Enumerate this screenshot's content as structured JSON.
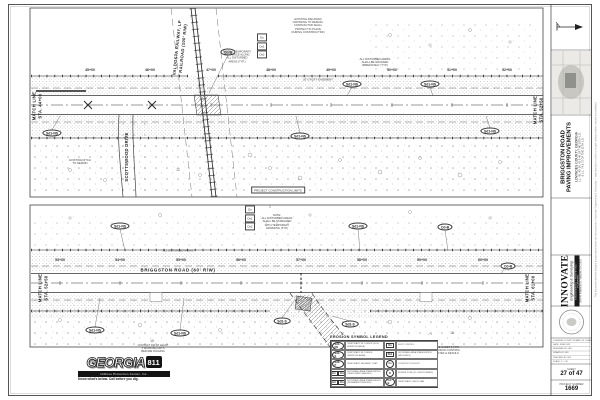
{
  "colors": {
    "paper": "#ffffff",
    "ink": "#2b2b2b",
    "muted": "#8f8f8f"
  },
  "plans": {
    "top": {
      "match_left": "MATCH LINE / STA. 44+00",
      "match_right": "MATCH LINE / STA. 52+50",
      "railroad_label": "VALDOSTA RAILWAY, LP RAILROAD (100' R/W)",
      "side_road_label": "SCOTTSWOOD DRIVE"
    },
    "bottom": {
      "match_left": "MATCH LINE / STA. 52+50",
      "match_right": "MATCH LINE / STA. 61+00",
      "road_label": "BRIGGSTON ROAD (60' R/W)"
    }
  },
  "annotations": [
    {
      "type": "vtext",
      "name": "match-line-top-left",
      "x": 37,
      "y": 106,
      "lines": [
        "MATCH LINE",
        "STA. 44+00"
      ]
    },
    {
      "type": "vtext",
      "name": "match-line-top-right",
      "x": 538,
      "y": 110,
      "lines": [
        "MATCH LINE",
        "STA. 52+50"
      ]
    },
    {
      "type": "vtext",
      "name": "match-line-bottom-left",
      "x": 43,
      "y": 288,
      "lines": [
        "MATCH LINE",
        "STA. 52+50"
      ]
    },
    {
      "type": "vtext",
      "name": "match-line-bottom-right",
      "x": 530,
      "y": 288,
      "lines": [
        "MATCH LINE",
        "STA. 61+00"
      ]
    },
    {
      "type": "vtext",
      "name": "railroad-label",
      "x": 180,
      "y": 48,
      "rot": -84,
      "lines": [
        "VALDOSTA RAILWAY, LP",
        "RAILROAD (100' R/W)"
      ]
    },
    {
      "type": "vtext",
      "name": "side-road-label",
      "x": 127,
      "y": 157,
      "lines": [
        "SCOTTSWOOD DRIVE"
      ]
    },
    {
      "type": "hlabel",
      "name": "road-label",
      "x": 178,
      "y": 270,
      "text": "BRIGGSTON ROAD (60' R/W)"
    },
    {
      "type": "station",
      "x": 90,
      "y": 70,
      "text": "45+00"
    },
    {
      "type": "station",
      "x": 150,
      "y": 70,
      "text": "46+00"
    },
    {
      "type": "station",
      "x": 211,
      "y": 70,
      "text": "47+00"
    },
    {
      "type": "station",
      "x": 271,
      "y": 70,
      "text": "48+00"
    },
    {
      "type": "station",
      "x": 331,
      "y": 70,
      "text": "49+00"
    },
    {
      "type": "station",
      "x": 392,
      "y": 70,
      "text": "50+00"
    },
    {
      "type": "station",
      "x": 452,
      "y": 70,
      "text": "51+00"
    },
    {
      "type": "station",
      "x": 507,
      "y": 70,
      "text": "52+00"
    },
    {
      "type": "station",
      "x": 60,
      "y": 260,
      "text": "53+00"
    },
    {
      "type": "station",
      "x": 120,
      "y": 260,
      "text": "54+00"
    },
    {
      "type": "station",
      "x": 181,
      "y": 260,
      "text": "55+00"
    },
    {
      "type": "station",
      "x": 241,
      "y": 260,
      "text": "56+00"
    },
    {
      "type": "station",
      "x": 301,
      "y": 260,
      "text": "57+00"
    },
    {
      "type": "station",
      "x": 362,
      "y": 260,
      "text": "58+00"
    },
    {
      "type": "station",
      "x": 422,
      "y": 260,
      "text": "59+00"
    },
    {
      "type": "station",
      "x": 483,
      "y": 260,
      "text": "60+00"
    },
    {
      "type": "oval",
      "x": 52,
      "y": 133,
      "text": "Sd1-NS"
    },
    {
      "type": "oval",
      "x": 228,
      "y": 52,
      "text": "Cd-B"
    },
    {
      "type": "oval",
      "x": 352,
      "y": 84,
      "text": "Sd1-NS"
    },
    {
      "type": "oval",
      "x": 430,
      "y": 84,
      "text": "Sd1-NS"
    },
    {
      "type": "oval",
      "x": 300,
      "y": 136,
      "text": "Sd1-NS"
    },
    {
      "type": "oval",
      "x": 490,
      "y": 131,
      "text": "Sd1-NS"
    },
    {
      "type": "oval",
      "x": 120,
      "y": 226,
      "text": "Sd1-NS"
    },
    {
      "type": "oval",
      "x": 358,
      "y": 226,
      "text": "Sd1-NS"
    },
    {
      "type": "oval",
      "x": 445,
      "y": 227,
      "text": "Cd-B"
    },
    {
      "type": "oval",
      "x": 95,
      "y": 330,
      "text": "Sd1-NS"
    },
    {
      "type": "oval",
      "x": 180,
      "y": 333,
      "text": "Sd1-NS"
    },
    {
      "type": "oval",
      "x": 282,
      "y": 321,
      "text": "Sd1-S"
    },
    {
      "type": "oval",
      "x": 350,
      "y": 324,
      "text": "Sd1-S"
    },
    {
      "type": "oval",
      "x": 508,
      "y": 266,
      "text": "Cd-B"
    },
    {
      "type": "note",
      "name": "silt-fence-note",
      "x": 237,
      "y": 57,
      "lines": [
        "INSTALL TEMPORARY",
        "SILT FENCE ALONG",
        "ALL DISTURBED",
        "AREAS (TYP.)"
      ]
    },
    {
      "type": "note",
      "name": "railroad-crossing-note",
      "x": 308,
      "y": 26,
      "lines": [
        "EXISTING RAILROAD",
        "CROSSING TO REMAIN.",
        "CONTRACTOR SHALL",
        "PROTECT IN PLACE",
        "DURING CONSTRUCTION"
      ]
    },
    {
      "type": "note",
      "name": "disturbed-areas-note-top",
      "x": 375,
      "y": 63,
      "lines": [
        "ALL DISTURBED AREAS",
        "SHALL BE GRASSED",
        "IMMEDIATELY (TYP.)"
      ]
    },
    {
      "type": "note",
      "name": "ditch-note",
      "x": 80,
      "y": 162,
      "lines": [
        "EXISTING DITCH",
        "TO REMAIN"
      ]
    },
    {
      "type": "note",
      "name": "utility-easement-label",
      "x": 318,
      "y": 80,
      "lines": [
        "20' UTILITY EASEMENT"
      ]
    },
    {
      "type": "note",
      "name": "disturbed-areas-note-bottom",
      "x": 277,
      "y": 222,
      "lines": [
        "NOTE:",
        "ALL DISTURBED AREAS",
        "SHALL BE STABILIZED",
        "WITH TEMPORARY",
        "GRASSING (TYP.)"
      ]
    },
    {
      "type": "note",
      "name": "disturbed-areas-label",
      "x": 178,
      "y": 251,
      "lines": [
        "ALL DISTURBED AREAS"
      ]
    },
    {
      "type": "note",
      "name": "legend-side-note",
      "x": 447,
      "y": 351,
      "lines": [
        "SEE SHEET 5 FOR",
        "EROSION CONTROL",
        "NOTES & DETAILS"
      ]
    },
    {
      "type": "note",
      "name": "call-before-dig-note",
      "x": 153,
      "y": 349,
      "lines": [
        "CONTACT 811 AT LEAST",
        "3 WORKING DAYS",
        "BEFORE DIGGING"
      ]
    },
    {
      "type": "boxnote",
      "name": "construction-limits-note",
      "x": 278,
      "y": 190,
      "text": "PROJECT CONSTRUCTION LIMITS"
    },
    {
      "type": "symstack",
      "name": "erosion-symbol-stack-top",
      "x": 262,
      "y": 46,
      "items": [
        "Du",
        "Ds1",
        "Ds2"
      ]
    },
    {
      "type": "symstack",
      "name": "erosion-symbol-stack-bottom",
      "x": 250,
      "y": 218,
      "items": [
        "Du",
        "Ds1",
        "Ds2"
      ]
    },
    {
      "type": "num",
      "x": 270,
      "y": 207,
      "text": "1"
    },
    {
      "type": "num",
      "x": 452,
      "y": 333,
      "text": "15"
    },
    {
      "type": "num",
      "x": 152,
      "y": 341,
      "text": "15"
    },
    {
      "type": "num",
      "x": 178,
      "y": 170,
      "text": "12"
    }
  ],
  "legend": {
    "title": "EROSION SYMBOL LEGEND",
    "rows": [
      {
        "l_sym": "Sd1-NS",
        "l_shape": "oval",
        "l_desc": "TEMPORARY SILT FENCE (NON-SENSITIVE AREA)",
        "r_sym": "Du",
        "r_shape": "box",
        "r_desc": "DUST CONTROL"
      },
      {
        "l_sym": "Sd1-S",
        "l_shape": "oval",
        "l_desc": "TEMPORARY SILT FENCE (SENSITIVE AREA)",
        "r_sym": "Ds1",
        "r_shape": "box",
        "r_desc": "DISTURBED AREA STABILIZATION (MULCHING)"
      },
      {
        "l_sym": "Sd2-P",
        "l_shape": "oval",
        "l_desc": "TEMPORARY SEDIMENT TRAP",
        "r_sym": "Co",
        "r_shape": "circle",
        "r_desc": "CONSTRUCTION EXIT"
      },
      {
        "l_sym": "Ds1 Ds2",
        "l_shape": "boxes",
        "l_desc": "DISTURBED AREA STABILIZATION (TEMPORARY SEEDING)",
        "r_sym": "B",
        "r_shape": "circle",
        "r_desc": "BUFFER ZONE (25' UNDISTURBED)"
      },
      {
        "l_sym": "Ds3 Ds4",
        "l_shape": "boxes",
        "l_desc": "DISTURBED AREA STABILIZATION (PERMANENT SEEDING)",
        "r_sym": "Cd-B",
        "r_shape": "oval",
        "r_desc": "TEMPORARY CHECK DAM"
      }
    ]
  },
  "call811": {
    "brand": "GEORGIA",
    "number": "811",
    "subtitle": "Utilities Protection Center, Inc.",
    "tagline": "Know what's below. Call before you dig."
  },
  "title_block": {
    "project_lines": [
      "BRIGGSTON ROAD",
      "PAVING IMPROVEMENTS",
      "LOWNDES COUNTY, GEORGIA",
      "L.L. 45, 49, 50, 41 & 40 OF THE 16TH L.D.",
      "& L.L. 74 & 75 OF THE 11TH L.D."
    ],
    "firm_name": "INNOVATE",
    "firm_tagline": "Engineering & Surveying",
    "firm_bar": "ENGINEERING • SURVEYING • PLANNING",
    "firm_address": "2804 N. Patterson St., Valdosta, GA 31602",
    "info_rows": [
      "LOWNDES COUNTY BOARD OF COMMISSIONERS",
      "DATE: JUNE 2023",
      "DESIGNED BY: IES",
      "DRAWN BY: IES",
      "CHECKED BY: IES",
      "SCALE: 1\" = 50'"
    ],
    "sheet_label": "SHEET",
    "sheet_value": "27 of 47",
    "project_label": "PROJECT NUMBER",
    "project_value": "1669",
    "edge_note": "This document and the designs incorporated herein are the property of Innovate Engineering & Surveying — reproduction in whole or in part without written consent is prohibited"
  }
}
